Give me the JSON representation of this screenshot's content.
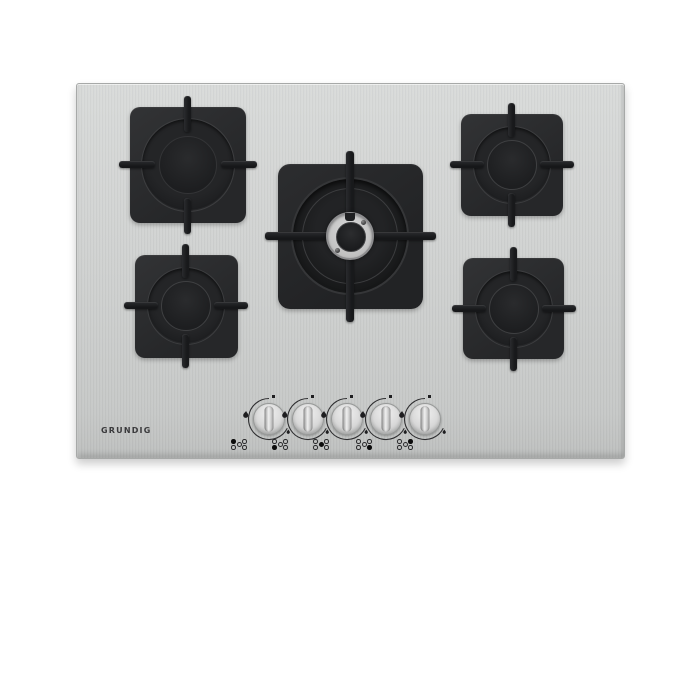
{
  "brand": {
    "logo_text": "GRUNDIG"
  },
  "palette": {
    "background": "#ffffff",
    "steel_surface": "#cdcfce",
    "steel_edge": "#a7a9a8",
    "burner_body": "#28292b",
    "grate": "#1d1e20",
    "knob_silver": "#d6d6d6",
    "markings": "#2a2a2c",
    "wok_steel_ring": "#c9c9c9"
  },
  "hob": {
    "burner_count": 5,
    "burners": [
      {
        "name": "rear-left",
        "size": "large"
      },
      {
        "name": "rear-right",
        "size": "medium"
      },
      {
        "name": "center",
        "size": "wok"
      },
      {
        "name": "front-left",
        "size": "medium"
      },
      {
        "name": "front-right",
        "size": "medium"
      }
    ]
  },
  "knobs": [
    {
      "name": "knob-1",
      "controls": "rear-left",
      "indicator_filled": "rear-left",
      "state": "off"
    },
    {
      "name": "knob-2",
      "controls": "front-left",
      "indicator_filled": "front-left",
      "state": "off"
    },
    {
      "name": "knob-3",
      "controls": "center",
      "indicator_filled": "center",
      "state": "off"
    },
    {
      "name": "knob-4",
      "controls": "front-right",
      "indicator_filled": "front-right",
      "state": "off"
    },
    {
      "name": "knob-5",
      "controls": "rear-right",
      "indicator_filled": "rear-right",
      "state": "off"
    }
  ],
  "dial": {
    "off_marker": "square",
    "max_marker": "large-flame",
    "min_marker": "small-flame"
  }
}
